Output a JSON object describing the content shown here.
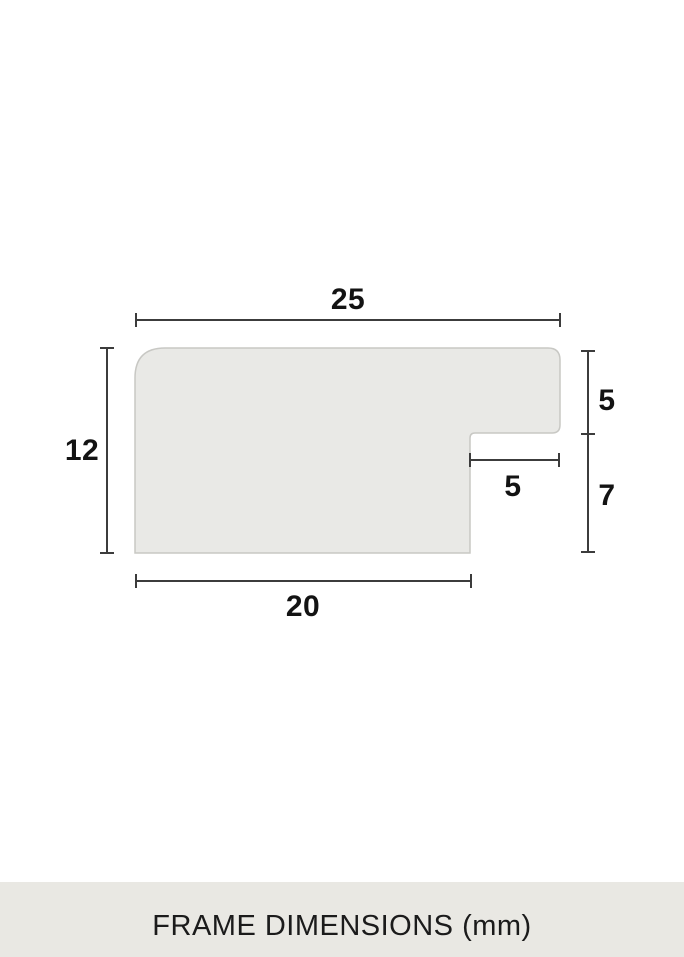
{
  "diagram": {
    "type": "frame-profile-cross-section",
    "dimensions": {
      "top_width": "25",
      "left_height": "12",
      "right_upper_height": "5",
      "rabbet_width": "5",
      "right_lower_height": "7",
      "bottom_width": "20"
    }
  },
  "footer": {
    "caption": "FRAME DIMENSIONS (mm)"
  },
  "colors": {
    "bg": "#ffffff",
    "shape_fill": "#e9e9e6",
    "shape_stroke": "#c8c8c4",
    "dim_line": "#3c3c3c",
    "label_color": "#131313",
    "footer_bg": "#e9e8e3",
    "footer_text": "#1b1b1b"
  }
}
